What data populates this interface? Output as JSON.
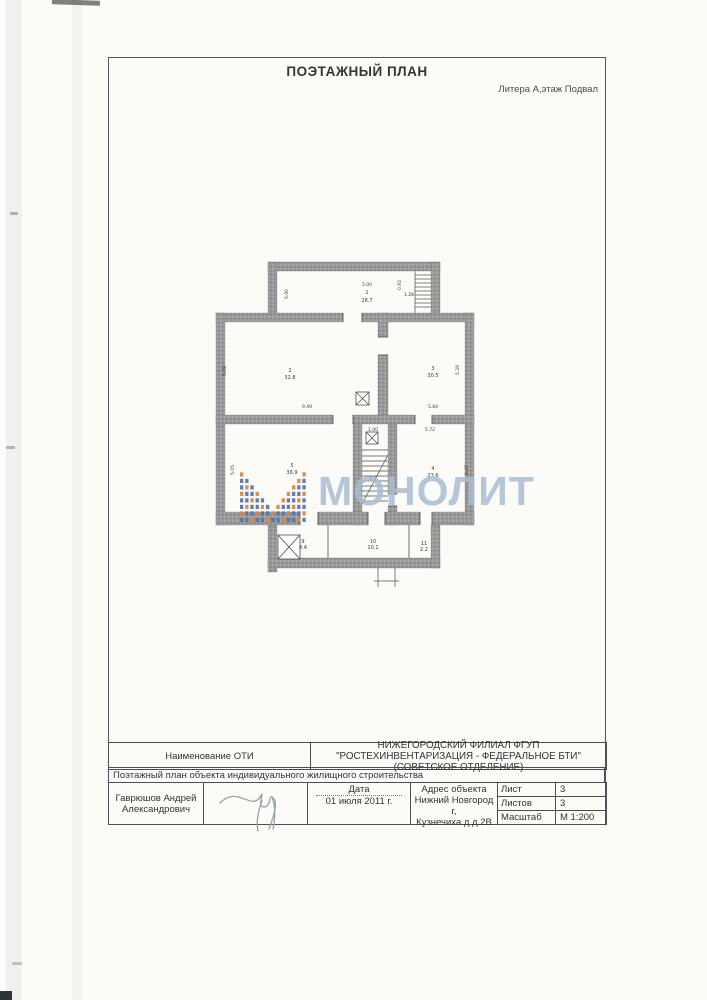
{
  "page": {
    "title": "ПОЭТАЖНЫЙ ПЛАН",
    "litera": "Литера А,этаж Подвал"
  },
  "watermark": {
    "text": "МОНОЛИТ",
    "text_color": "#a9bdd3",
    "logo_blue": "#4f74ae",
    "logo_orange": "#e2813c"
  },
  "plan": {
    "rooms": [
      {
        "num": "1",
        "area": "28.7"
      },
      {
        "num": "2",
        "area": "32.8"
      },
      {
        "num": "3",
        "area": "30.5"
      },
      {
        "num": "4",
        "area": "23.6"
      },
      {
        "num": "5",
        "area": "36.9"
      },
      {
        "num": "9",
        "area": "8.4"
      },
      {
        "num": "10",
        "area": "10.1"
      },
      {
        "num": "11",
        "area": "2.2"
      }
    ],
    "dims": [
      "5.00",
      "0.92",
      "1.28",
      "5.90",
      "5.08",
      "9.49",
      "5.29",
      "5.84",
      "5.72",
      "4.47",
      "5.05",
      "1.00",
      "2.6"
    ]
  },
  "footer": {
    "oti_label": "Наименование ОТИ",
    "oti_value": "НИЖЕГОРОДСКИЙ ФИЛИАЛ ФГУП \"РОСТЕХИНВЕНТАРИЗАЦИЯ - ФЕДЕРАЛЬНОЕ БТИ\" (СОВЕТСКОЕ ОТДЕЛЕНИЕ)",
    "doc_type": "Поэтажный план объекта индивидуального жилищного строительства",
    "executor": "Гаврюшов Андрей Александрович",
    "date_label": "Дата",
    "date_value": "01 июля 2011 г.",
    "address_label": "Адрес объекта",
    "address_line1": "Нижний Новгород г,",
    "address_line2": "Кузнечиха д д.2В",
    "sheet_label": "Лист",
    "sheet_value": "3",
    "sheets_label": "Листов",
    "sheets_value": "3",
    "scale_label": "Масштаб",
    "scale_value": "М 1:200"
  }
}
